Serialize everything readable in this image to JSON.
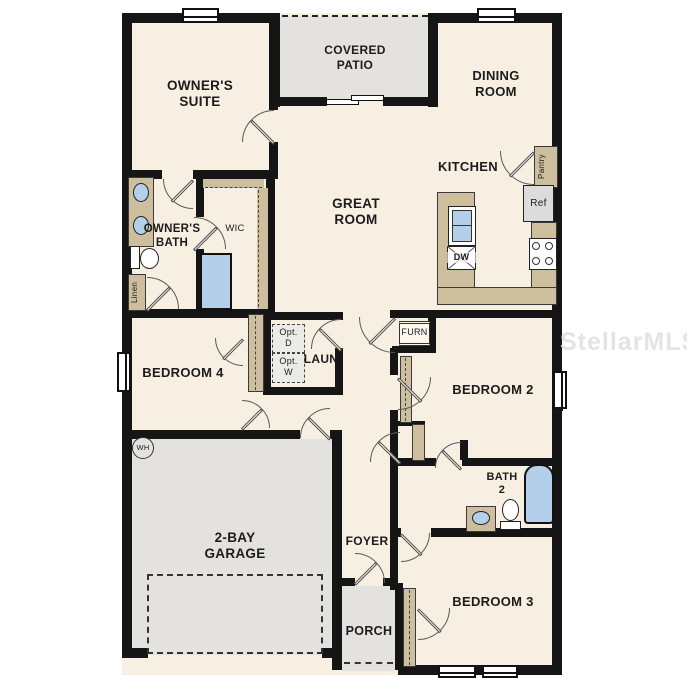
{
  "watermark": "StellarMLS",
  "colors": {
    "floor": "#f7efe1",
    "outdoor": "#e3e2df",
    "wall": "#151515",
    "cabinet": "#cdbf9e",
    "fixture_blue": "#b4cfe9"
  },
  "rooms": {
    "owners_suite": "OWNER'S\nSUITE",
    "covered_patio": "COVERED\nPATIO",
    "dining_room": "DINING\nROOM",
    "great_room": "GREAT\nROOM",
    "kitchen": "KITCHEN",
    "owners_bath": "OWNER'S\nBATH",
    "wic": "WIC",
    "bedroom_4": "BEDROOM 4",
    "laundry": "LAUN",
    "bedroom_2": "BEDROOM 2",
    "bath_2": "BATH\n2",
    "garage": "2-BAY\nGARAGE",
    "foyer": "FOYER",
    "porch": "PORCH",
    "bedroom_3": "BEDROOM 3"
  },
  "labels": {
    "pantry": "Pantry",
    "ref": "Ref",
    "dw": "DW",
    "linen": "Linen",
    "opt_dryer": "Opt.\nD",
    "opt_washer": "Opt.\nW",
    "furnace": "FURN",
    "water_heater": "WH"
  }
}
